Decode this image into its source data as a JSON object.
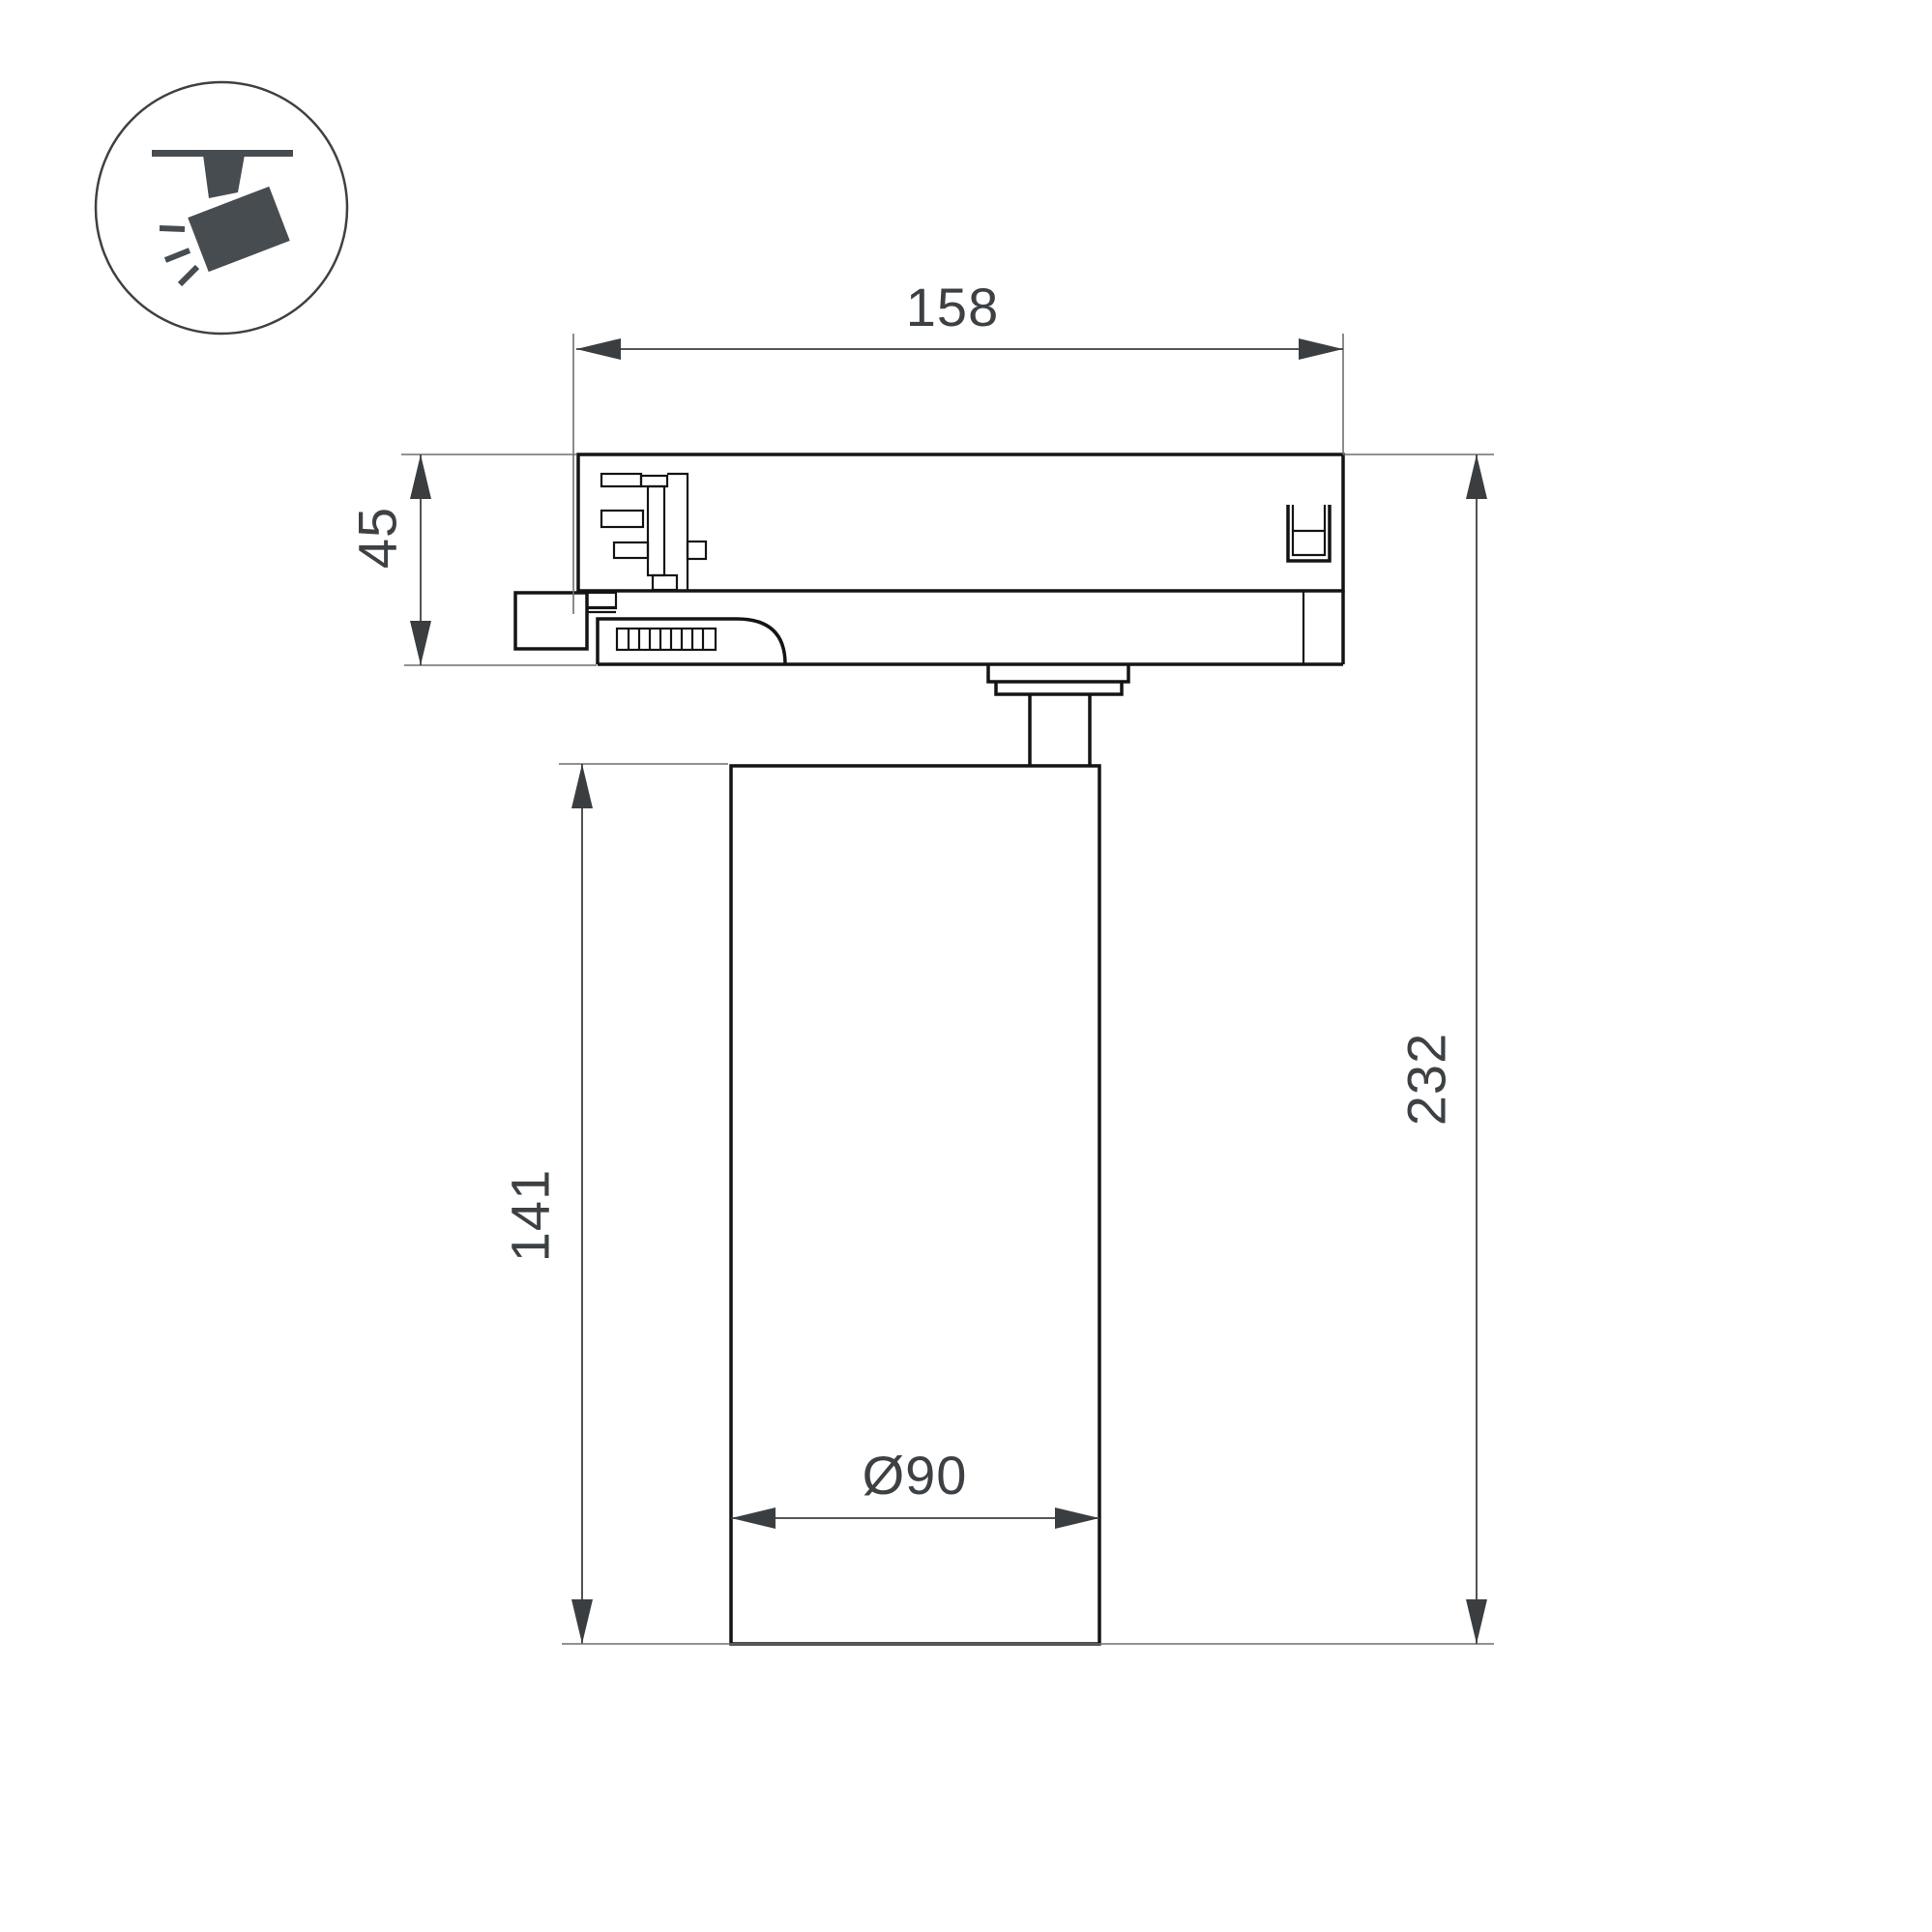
{
  "page": {
    "background": "#ffffff",
    "type": "technical-dimension-drawing",
    "subject": "track-mounted spotlight luminaire side view"
  },
  "icon_badge": {
    "icon": "track-spotlight-icon",
    "glyph_color": "#474c51",
    "circle_stroke_color": "#3d4144"
  },
  "drawing": {
    "object_line_color": "#141414",
    "dimension_line_color": "#3f3f3f",
    "extension_line_color": "#6f6f6f",
    "text_color": "#3d4144",
    "dimensions": {
      "width_top": {
        "value": "158",
        "meaning": "track adapter length"
      },
      "adapter_height": {
        "value": "45",
        "meaning": "track adapter height"
      },
      "body_height": {
        "value": "141",
        "meaning": "cylinder body height"
      },
      "total_height": {
        "value": "232",
        "meaning": "overall height"
      },
      "diameter": {
        "value": "Ø90",
        "meaning": "cylinder diameter"
      }
    }
  }
}
